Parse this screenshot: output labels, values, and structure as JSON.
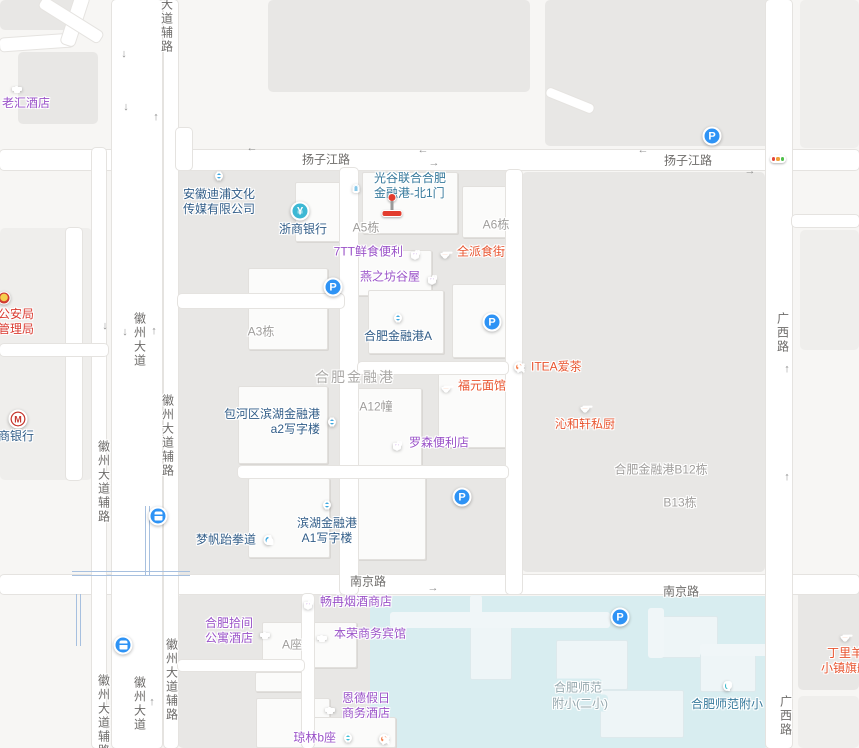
{
  "map": {
    "colors": {
      "background": "#f7f6f4",
      "block": "#e8e7e5",
      "school_area": "#d8edf0",
      "road": "#ffffff",
      "road_label": "#6e6c6a",
      "area_label": "#a09e9c",
      "poi_blue_text": "#315d88",
      "poi_purple_text": "#9a52c8",
      "poi_orange_text": "#e8542f",
      "poi_red_text": "#d93a30",
      "poi_gate_text": "#35789b",
      "icon_blue": "#3fa9e0",
      "icon_purple": "#a05fd0",
      "icon_orange": "#f5814e",
      "icon_parking": "#2e93f5",
      "icon_bank_teal": "#3db8d4",
      "icon_entrance": "#87c8ea",
      "icon_school": "#35b6c9",
      "icon_cyan": "#3ec0d8",
      "marker_red": "#e23c2e"
    },
    "road_labels": [
      {
        "t": "扬子江路",
        "x": 326,
        "y": 159,
        "v": 0
      },
      {
        "t": "扬子江路",
        "x": 688,
        "y": 160,
        "v": 0
      },
      {
        "t": "南京路",
        "x": 368,
        "y": 581,
        "v": 0
      },
      {
        "t": "南京路",
        "x": 681,
        "y": 591,
        "v": 0
      },
      {
        "t": "徽州大道",
        "x": 140,
        "y": 340,
        "v": 1
      },
      {
        "t": "徽州大道辅路",
        "x": 168,
        "y": 436,
        "v": 1
      },
      {
        "t": "徽州大道辅路",
        "x": 104,
        "y": 482,
        "v": 1
      },
      {
        "t": "徽州大道辅路",
        "x": 104,
        "y": 716,
        "v": 1
      },
      {
        "t": "徽州大道",
        "x": 140,
        "y": 704,
        "v": 1
      },
      {
        "t": "徽州大道辅路",
        "x": 172,
        "y": 680,
        "v": 1
      },
      {
        "t": "大道辅路",
        "x": 167,
        "y": 26,
        "v": 1
      },
      {
        "t": "广西路",
        "x": 783,
        "y": 333,
        "v": 1
      },
      {
        "t": "广西路",
        "x": 786,
        "y": 716,
        "v": 1
      }
    ],
    "area_labels": [
      {
        "t": "A5栋",
        "x": 366,
        "y": 227
      },
      {
        "t": "A6栋",
        "x": 496,
        "y": 224
      },
      {
        "t": "A3栋",
        "x": 261,
        "y": 331
      },
      {
        "t": "合肥金融港",
        "x": 355,
        "y": 377,
        "big": 1
      },
      {
        "t": "A12幢",
        "x": 376,
        "y": 406
      },
      {
        "t": "合肥金融港B12栋",
        "x": 661,
        "y": 469
      },
      {
        "t": "B13栋",
        "x": 680,
        "y": 502
      },
      {
        "t": "A座",
        "x": 292,
        "y": 644
      },
      {
        "t": "合肥师范",
        "x": 578,
        "y": 687,
        "school": 1
      },
      {
        "t": "附小(二小)",
        "x": 580,
        "y": 703,
        "school": 1
      }
    ],
    "pois": [
      {
        "id": "laohui-hotel",
        "icon": "hotel",
        "bg": "#a05fd0",
        "color": "purple",
        "x": 17,
        "y": 85,
        "side": "below",
        "dx": 9,
        "lines": [
          "老汇酒店"
        ]
      },
      {
        "id": "dipu-media-company",
        "icon": "bldg",
        "bg": "#3fa9e0",
        "color": "blue",
        "x": 219,
        "y": 176,
        "side": "below",
        "lines": [
          "安徽迪浦文化",
          "传媒有限公司"
        ]
      },
      {
        "id": "zheshang-bank",
        "icon": "yen",
        "bg": "#3db8d4",
        "color": "blue",
        "x": 300,
        "y": 211,
        "side": "below",
        "dx": 3,
        "lines": [
          "浙商银行"
        ]
      },
      {
        "id": "gate-north1",
        "icon": "door",
        "bg": "#87c8ea",
        "color": "gate",
        "x": 356,
        "y": 186,
        "side": "right",
        "dx": 6,
        "lines": [
          "光谷联合合肥",
          "金融港-北1门"
        ]
      },
      {
        "id": "7tt-store",
        "icon": "shop",
        "bg": "#a05fd0",
        "color": "purple",
        "x": 415,
        "y": 252,
        "side": "left",
        "lines": [
          "7TT鲜食便利"
        ]
      },
      {
        "id": "quanpai-food",
        "icon": "food",
        "bg": "#f5814e",
        "color": "orange",
        "x": 445,
        "y": 252,
        "side": "right",
        "lines": [
          "全派食街"
        ]
      },
      {
        "id": "yanzhifang",
        "icon": "shop",
        "bg": "#a05fd0",
        "color": "purple",
        "x": 432,
        "y": 277,
        "side": "left",
        "lines": [
          "燕之坊谷屋"
        ]
      },
      {
        "id": "jinronggang-a",
        "icon": "bldg",
        "bg": "#3fa9e0",
        "color": "blue",
        "x": 398,
        "y": 318,
        "side": "below",
        "lines": [
          "合肥金融港A"
        ]
      },
      {
        "id": "itea-tea",
        "icon": "fork",
        "bg": "#f5814e",
        "color": "orange",
        "x": 519,
        "y": 367,
        "side": "right",
        "lines": [
          "ITEA爱茶"
        ]
      },
      {
        "id": "fuyuan-noodle",
        "icon": "food",
        "bg": "#f5814e",
        "color": "orange",
        "x": 446,
        "y": 386,
        "side": "right",
        "lines": [
          "福元面馆"
        ]
      },
      {
        "id": "qinhexuan",
        "icon": "food",
        "bg": "#f5814e",
        "color": "orange",
        "x": 585,
        "y": 406,
        "side": "below",
        "lines": [
          "沁和轩私厨"
        ]
      },
      {
        "id": "a2-tower",
        "icon": "bldg",
        "bg": "#3fa9e0",
        "color": "blue",
        "x": 332,
        "y": 422,
        "side": "left",
        "lines": [
          "包河区滨湖金融港",
          "a2写字楼"
        ]
      },
      {
        "id": "lawson",
        "icon": "shop",
        "bg": "#a05fd0",
        "color": "purple",
        "x": 397,
        "y": 443,
        "side": "right",
        "lines": [
          "罗森便利店"
        ]
      },
      {
        "id": "a1-tower",
        "icon": "bldg",
        "bg": "#3fa9e0",
        "color": "blue",
        "x": 327,
        "y": 505,
        "side": "below",
        "lines": [
          "滨湖金融港",
          "A1写字楼"
        ]
      },
      {
        "id": "mengfan-taekwondo",
        "icon": "person",
        "bg": "#3fa9e0",
        "color": "blue",
        "x": 268,
        "y": 540,
        "side": "left",
        "lines": [
          "梦帆跆拳道"
        ]
      },
      {
        "id": "changran-tobacco",
        "icon": "shop",
        "bg": "#a05fd0",
        "color": "purple",
        "x": 308,
        "y": 602,
        "side": "right",
        "lines": [
          "畅冉烟酒商店"
        ]
      },
      {
        "id": "shijian-hotel",
        "icon": "hotel",
        "bg": "#a05fd0",
        "color": "purple",
        "x": 265,
        "y": 631,
        "side": "left",
        "lines": [
          "合肥拾间",
          "公寓酒店"
        ]
      },
      {
        "id": "benrong-hotel",
        "icon": "hotel",
        "bg": "#a05fd0",
        "color": "purple",
        "x": 322,
        "y": 634,
        "side": "right",
        "lines": [
          "本荣商务宾馆"
        ]
      },
      {
        "id": "ende-hotel",
        "icon": "hotel",
        "bg": "#a05fd0",
        "color": "purple",
        "x": 330,
        "y": 706,
        "side": "right",
        "lines": [
          "恩德假日",
          "商务酒店"
        ]
      },
      {
        "id": "qionglin-b",
        "icon": "bldg",
        "bg": "#3ec0d8",
        "color": "purple",
        "x": 348,
        "y": 738,
        "side": "left",
        "lines": [
          "琼林b座"
        ]
      },
      {
        "id": "restaurant-unnamed",
        "icon": "fork",
        "bg": "#f5814e",
        "color": "orange",
        "x": 384,
        "y": 739,
        "side": "none",
        "lines": []
      },
      {
        "id": "shifan-fuxiao",
        "icon": "tree",
        "bg": "#35b6c9",
        "color": "gate",
        "x": 727,
        "y": 686,
        "side": "below",
        "lines": [
          "合肥师范附小"
        ]
      },
      {
        "id": "dingliyang",
        "icon": "food",
        "bg": "#f5814e",
        "color": "orange",
        "x": 845,
        "y": 635,
        "side": "below",
        "lines": [
          "丁里羊",
          "小镇旗舰"
        ]
      },
      {
        "id": "cmb-bank",
        "icon": "m",
        "bg": "#ffffff",
        "color": "blue",
        "x": 18,
        "y": 419,
        "lx": -20,
        "ly": 10,
        "align": "left",
        "lines": [
          "商银行"
        ]
      },
      {
        "id": "public-security-bureau",
        "icon": "emblem",
        "bg": "",
        "color": "red",
        "x": 4,
        "y": 298,
        "lx": -6,
        "ly": 9,
        "align": "left",
        "lines": [
          "公安局",
          "管理局"
        ]
      }
    ],
    "utility_icons": [
      {
        "type": "p",
        "x": 712,
        "y": 136
      },
      {
        "type": "p",
        "x": 333,
        "y": 287
      },
      {
        "type": "p",
        "x": 492,
        "y": 322
      },
      {
        "type": "p",
        "x": 462,
        "y": 497
      },
      {
        "type": "p",
        "x": 620,
        "y": 617
      },
      {
        "type": "bus",
        "x": 158,
        "y": 516
      },
      {
        "type": "bus",
        "x": 123,
        "y": 645
      }
    ],
    "traffic_light": {
      "x": 778,
      "y": 159,
      "dot_colors": [
        "#e4483c",
        "#f0a03a",
        "#4fbf4a"
      ]
    },
    "marker": {
      "x": 392,
      "y": 193
    },
    "arrows": [
      {
        "x": 252,
        "y": 148,
        "ch": "←"
      },
      {
        "x": 423,
        "y": 150,
        "ch": "←"
      },
      {
        "x": 434,
        "y": 163,
        "ch": "→"
      },
      {
        "x": 643,
        "y": 150,
        "ch": "←"
      },
      {
        "x": 750,
        "y": 171,
        "ch": "→"
      },
      {
        "x": 124,
        "y": 54,
        "ch": "↓"
      },
      {
        "x": 126,
        "y": 107,
        "ch": "↓"
      },
      {
        "x": 156,
        "y": 117,
        "ch": "↑"
      },
      {
        "x": 105,
        "y": 326,
        "ch": "↓"
      },
      {
        "x": 125,
        "y": 332,
        "ch": "↓"
      },
      {
        "x": 154,
        "y": 331,
        "ch": "↑"
      },
      {
        "x": 152,
        "y": 702,
        "ch": "↑"
      },
      {
        "x": 433,
        "y": 588,
        "ch": "→"
      },
      {
        "x": 787,
        "y": 369,
        "ch": "↑"
      },
      {
        "x": 787,
        "y": 477,
        "ch": "↑"
      }
    ],
    "geometry": {
      "plots": [
        {
          "x": 268,
          "y": 0,
          "w": 262,
          "h": 92
        },
        {
          "x": 545,
          "y": 0,
          "w": 228,
          "h": 146
        },
        {
          "x": 800,
          "y": 0,
          "w": 59,
          "h": 148,
          "light": 1
        },
        {
          "x": 0,
          "y": 0,
          "w": 78,
          "h": 30
        },
        {
          "x": 18,
          "y": 52,
          "w": 80,
          "h": 72
        },
        {
          "x": 0,
          "y": 228,
          "w": 92,
          "h": 252,
          "light": 1
        },
        {
          "x": 178,
          "y": 168,
          "w": 330,
          "h": 407
        },
        {
          "x": 522,
          "y": 172,
          "w": 243,
          "h": 400
        },
        {
          "x": 178,
          "y": 594,
          "w": 192,
          "h": 154
        },
        {
          "x": 798,
          "y": 578,
          "w": 61,
          "h": 112
        },
        {
          "x": 798,
          "y": 696,
          "w": 61,
          "h": 52,
          "light": 1
        },
        {
          "x": 800,
          "y": 230,
          "w": 59,
          "h": 120,
          "light": 1
        }
      ],
      "school_area": {
        "x": 370,
        "y": 596,
        "w": 398,
        "h": 152
      },
      "buildings": [
        {
          "x": 295,
          "y": 182,
          "w": 52,
          "h": 60
        },
        {
          "x": 362,
          "y": 172,
          "w": 96,
          "h": 62
        },
        {
          "x": 462,
          "y": 186,
          "w": 56,
          "h": 52
        },
        {
          "x": 248,
          "y": 268,
          "w": 80,
          "h": 82
        },
        {
          "x": 352,
          "y": 250,
          "w": 80,
          "h": 46
        },
        {
          "x": 368,
          "y": 290,
          "w": 76,
          "h": 64
        },
        {
          "x": 452,
          "y": 284,
          "w": 60,
          "h": 74
        },
        {
          "x": 238,
          "y": 386,
          "w": 90,
          "h": 78
        },
        {
          "x": 344,
          "y": 388,
          "w": 78,
          "h": 80
        },
        {
          "x": 438,
          "y": 364,
          "w": 72,
          "h": 84
        },
        {
          "x": 248,
          "y": 478,
          "w": 82,
          "h": 80
        },
        {
          "x": 342,
          "y": 476,
          "w": 84,
          "h": 84
        },
        {
          "x": 262,
          "y": 622,
          "w": 95,
          "h": 46
        },
        {
          "x": 255,
          "y": 672,
          "w": 52,
          "h": 20
        },
        {
          "x": 256,
          "y": 698,
          "w": 74,
          "h": 50
        },
        {
          "x": 310,
          "y": 717,
          "w": 86,
          "h": 31
        },
        {
          "x": 470,
          "y": 618,
          "w": 42,
          "h": 62,
          "sc": 1
        },
        {
          "x": 556,
          "y": 640,
          "w": 72,
          "h": 50,
          "sc": 1
        },
        {
          "x": 656,
          "y": 616,
          "w": 62,
          "h": 42,
          "sc": 1
        },
        {
          "x": 600,
          "y": 690,
          "w": 84,
          "h": 48,
          "sc": 1
        },
        {
          "x": 700,
          "y": 652,
          "w": 56,
          "h": 40,
          "sc": 1
        }
      ],
      "school_paths": [
        {
          "x": 390,
          "y": 612,
          "w": 220,
          "h": 16
        },
        {
          "x": 470,
          "y": 595,
          "w": 12,
          "h": 24
        },
        {
          "x": 648,
          "y": 608,
          "w": 16,
          "h": 50
        },
        {
          "x": 700,
          "y": 644,
          "w": 68,
          "h": 12
        }
      ],
      "roads": [
        {
          "x": 0,
          "y": 150,
          "w": 859,
          "h": 20
        },
        {
          "x": 0,
          "y": 575,
          "w": 859,
          "h": 19
        },
        {
          "x": 112,
          "y": 0,
          "w": 50,
          "h": 748
        },
        {
          "x": 92,
          "y": 148,
          "w": 14,
          "h": 600
        },
        {
          "x": 164,
          "y": 0,
          "w": 14,
          "h": 748
        },
        {
          "x": 766,
          "y": 0,
          "w": 26,
          "h": 748
        },
        {
          "x": 340,
          "y": 168,
          "w": 18,
          "h": 426
        },
        {
          "x": 178,
          "y": 294,
          "w": 166,
          "h": 14
        },
        {
          "x": 506,
          "y": 170,
          "w": 16,
          "h": 424
        },
        {
          "x": 358,
          "y": 362,
          "w": 150,
          "h": 12
        },
        {
          "x": 238,
          "y": 466,
          "w": 270,
          "h": 12
        },
        {
          "x": 66,
          "y": 228,
          "w": 16,
          "h": 252
        },
        {
          "x": 0,
          "y": 344,
          "w": 108,
          "h": 12
        },
        {
          "x": 302,
          "y": 594,
          "w": 12,
          "h": 154
        },
        {
          "x": 178,
          "y": 660,
          "w": 126,
          "h": 11
        },
        {
          "x": 176,
          "y": 128,
          "w": 16,
          "h": 42
        },
        {
          "x": 792,
          "y": 215,
          "w": 67,
          "h": 12
        }
      ],
      "diag_roads": [
        {
          "x": 0,
          "y": 36,
          "w": 74,
          "h": 13,
          "rot": -4
        },
        {
          "x": 68,
          "y": -6,
          "w": 14,
          "h": 52,
          "rot": 18
        },
        {
          "x": 36,
          "y": 14,
          "w": 70,
          "h": 12,
          "rot": 32
        },
        {
          "x": 545,
          "y": 96,
          "w": 50,
          "h": 9,
          "rot": 22
        }
      ],
      "metro_lines": [
        {
          "x": 145,
          "y": 506,
          "w": 5,
          "h": 69,
          "v": 1
        },
        {
          "x": 72,
          "y": 571,
          "w": 118,
          "h": 5,
          "v": 0
        },
        {
          "x": 76,
          "y": 594,
          "w": 5,
          "h": 52,
          "v": 1
        }
      ]
    }
  }
}
